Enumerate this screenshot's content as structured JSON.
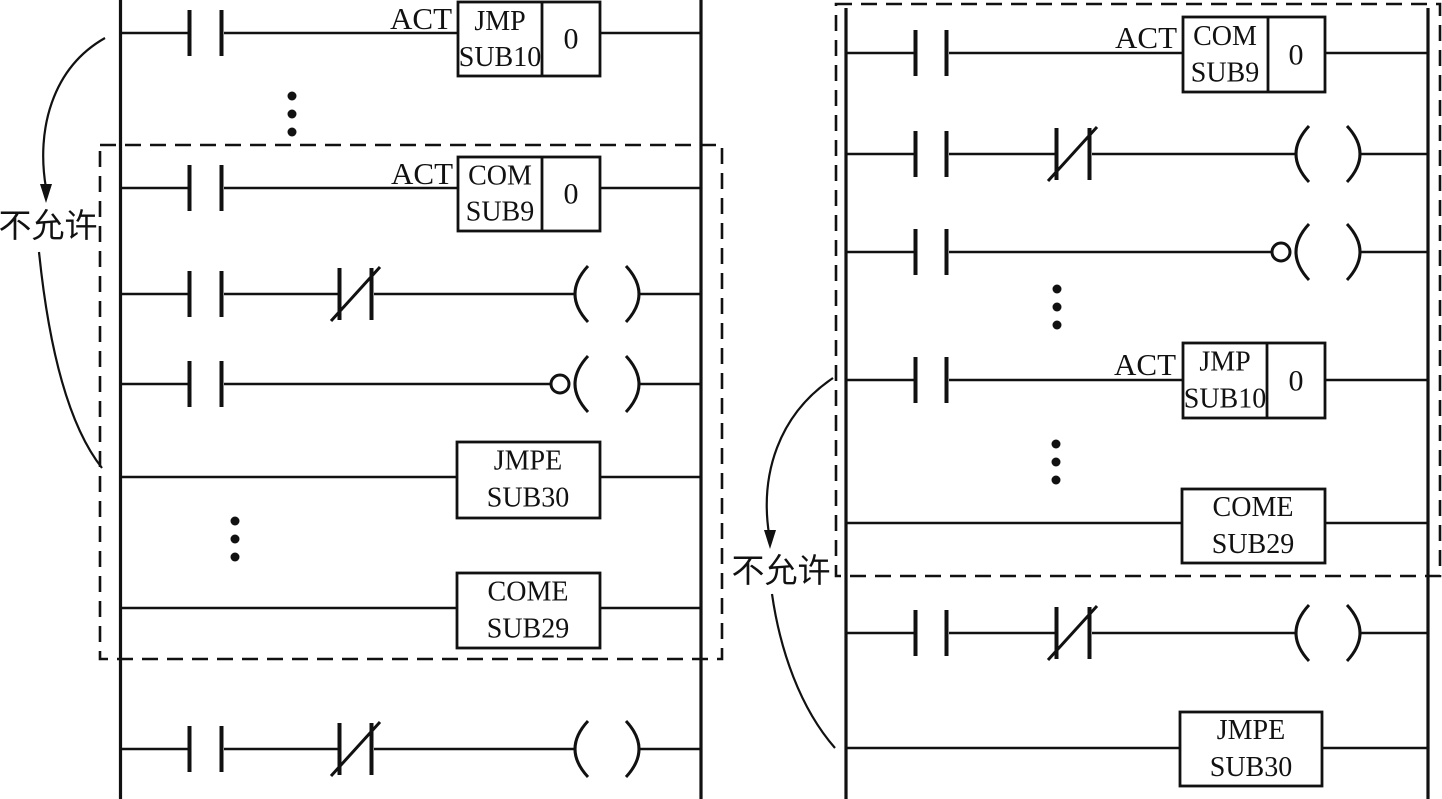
{
  "figure": {
    "type": "plc-ladder-diagram",
    "ink_color": "#111111",
    "background_color": "#ffffff"
  },
  "left_ladder": {
    "not_allowed_label": "不允许",
    "jmp_rung": {
      "act": "ACT",
      "mnemonic": "JMP",
      "operand": "SUB10",
      "value": "0"
    },
    "com_rung": {
      "act": "ACT",
      "mnemonic": "COM",
      "operand": "SUB9",
      "value": "0"
    },
    "jmpe_rung": {
      "mnemonic": "JMPE",
      "operand": "SUB30"
    },
    "come_rung": {
      "mnemonic": "COME",
      "operand": "SUB29"
    }
  },
  "right_ladder": {
    "not_allowed_label": "不允许",
    "com_rung": {
      "act": "ACT",
      "mnemonic": "COM",
      "operand": "SUB9",
      "value": "0"
    },
    "jmp_rung": {
      "act": "ACT",
      "mnemonic": "JMP",
      "operand": "SUB10",
      "value": "0"
    },
    "come_rung": {
      "mnemonic": "COME",
      "operand": "SUB29"
    },
    "jmpe_rung": {
      "mnemonic": "JMPE",
      "operand": "SUB30"
    }
  }
}
